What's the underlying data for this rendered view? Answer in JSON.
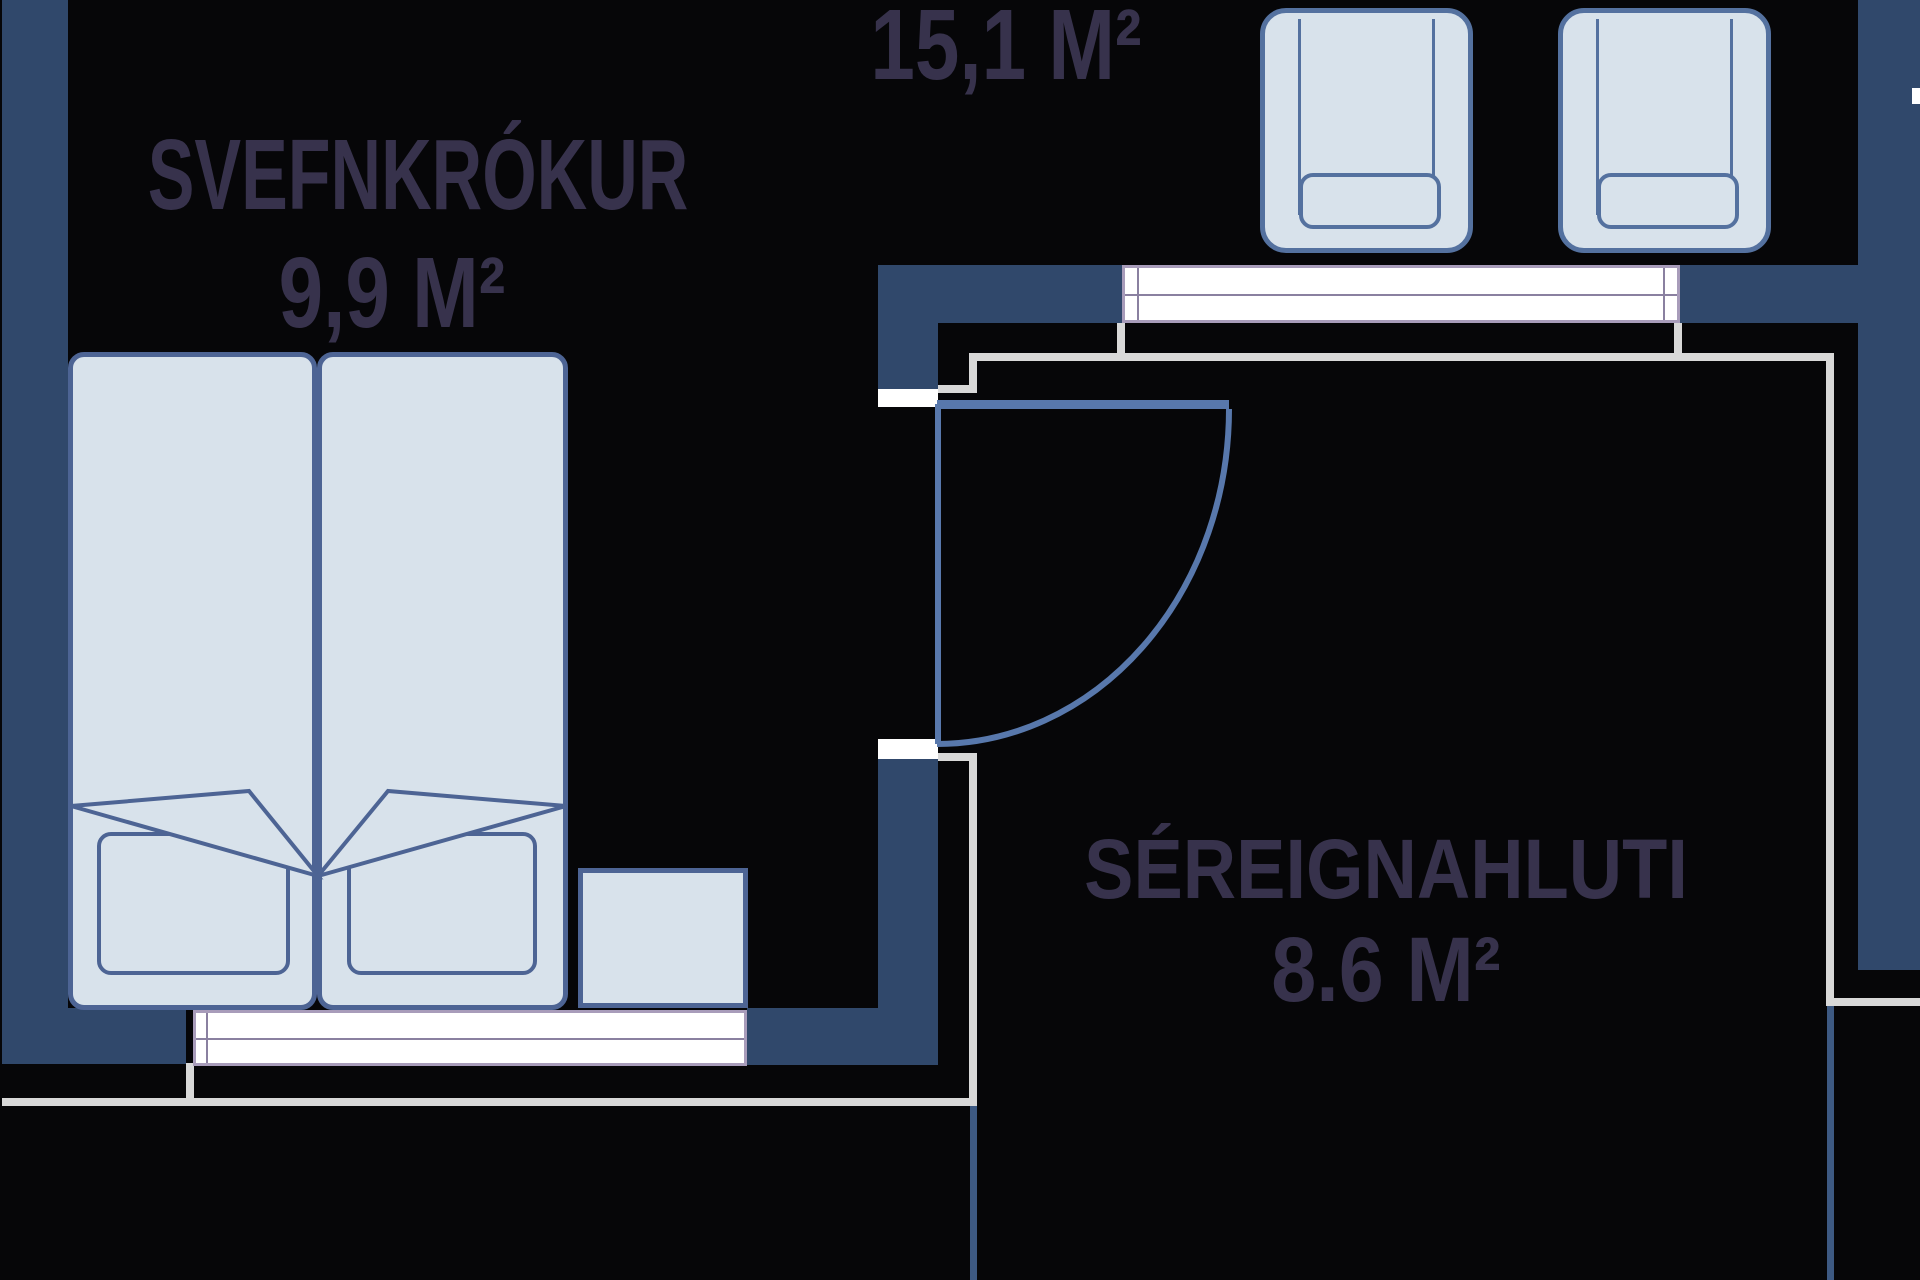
{
  "floorplan": {
    "title": "apartment floor plan",
    "rooms": [
      {
        "id": "svefnkrokur",
        "label": "SVEFNKRÓKUR",
        "area": "9,9 M²"
      },
      {
        "id": "hall",
        "label": "",
        "area": "15,1 M²"
      },
      {
        "id": "sereignahluti",
        "label": "SÉREIGNAHLUTI",
        "area": "8.6 M²"
      }
    ],
    "furniture": {
      "bed": "double-bed",
      "pillows": [
        "pillow-left",
        "pillow-right"
      ],
      "nightstand": "nightstand",
      "bench": "low-shelf-bench",
      "sideboard": "wall-table",
      "chairs": [
        "chair-left",
        "chair-right"
      ],
      "door": "swing-door"
    },
    "colors": {
      "background": "#060608",
      "wall_navy": "#30486b",
      "furniture_outline": "#4d6494",
      "door_blue": "#5878ac",
      "light_fill": "#d8e2eb",
      "thin_line_gray": "#d8d8d8",
      "thin_line_blue": "#3d5982",
      "bar_white": "#ffffff",
      "bar_border": "#a89cba",
      "text": "#37324c"
    }
  }
}
